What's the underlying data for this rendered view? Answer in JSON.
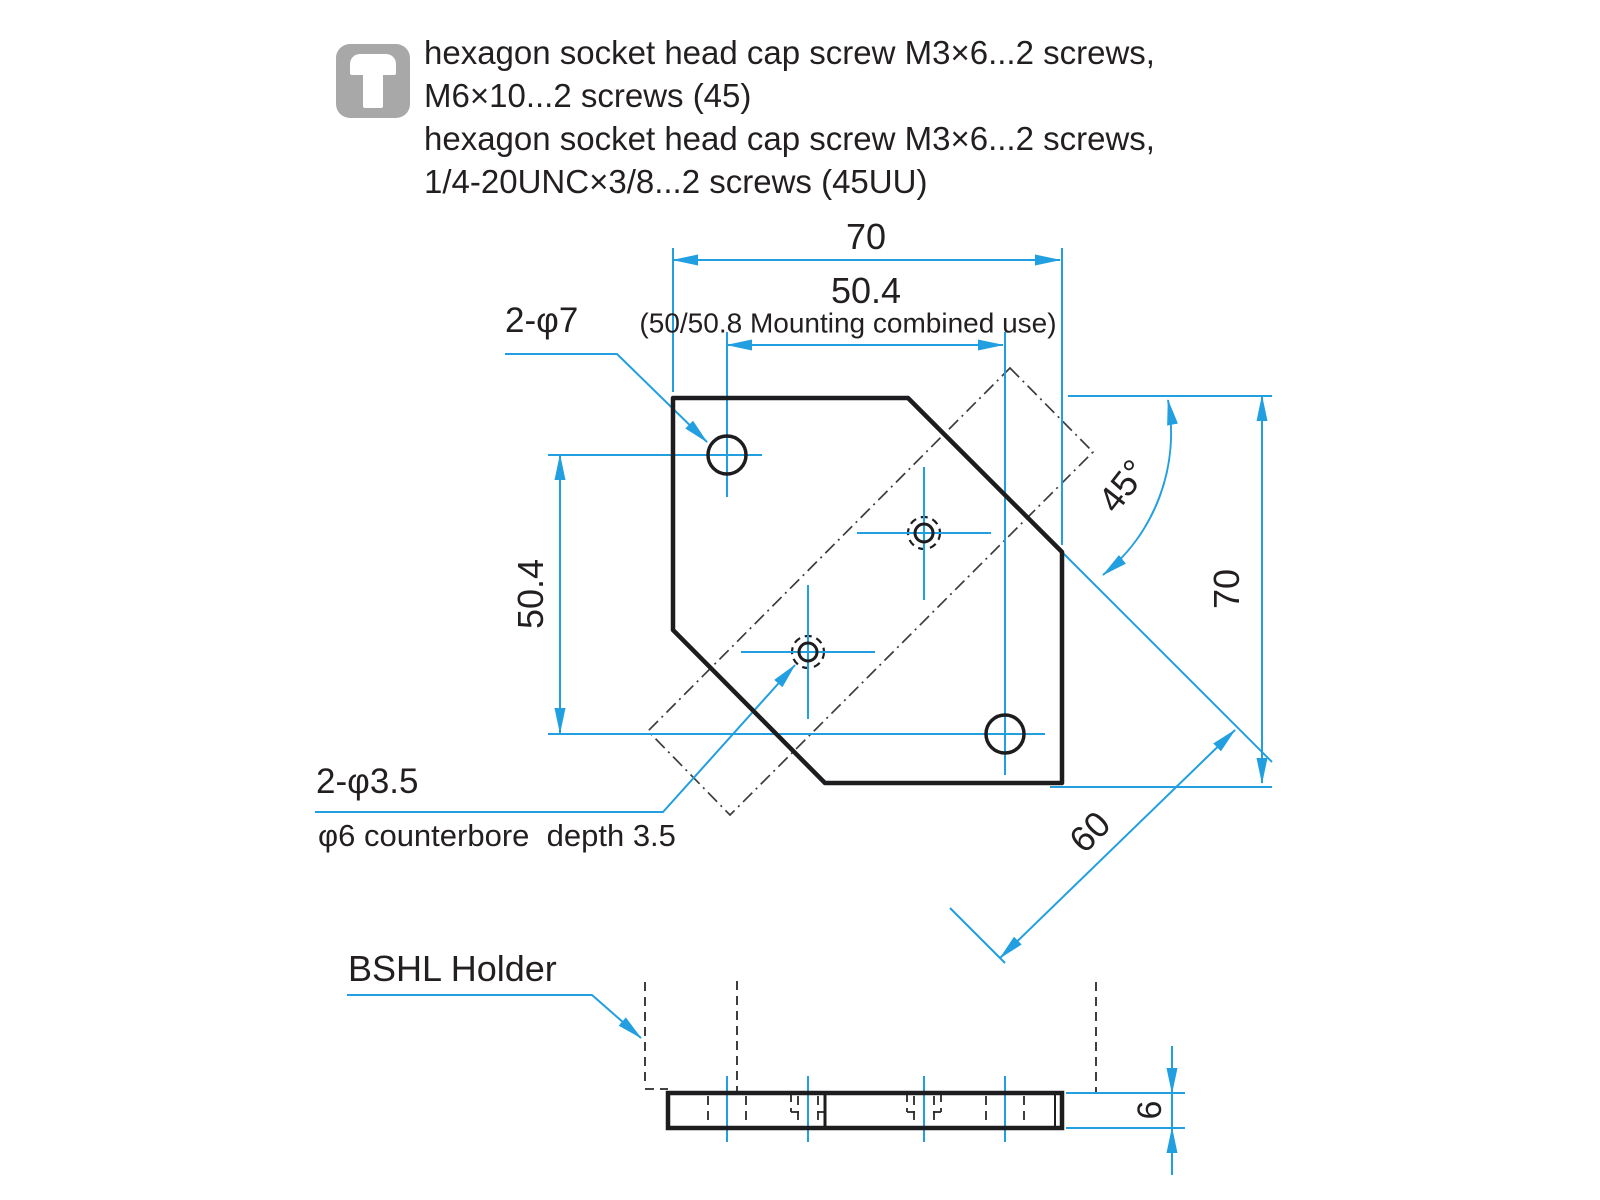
{
  "notes": {
    "icon": "screw-icon",
    "lines": [
      "hexagon socket head cap screw M3×6...2 screws,",
      "M6×10...2 screws (45)",
      "hexagon socket head cap screw M3×6...2 screws,",
      "1/4-20UNC×3/8...2 screws (45UU)"
    ]
  },
  "part_label": "BSHL Holder",
  "top_view": {
    "dims": {
      "width": "70",
      "mounting": "50.4",
      "mounting_note": "(50/50.8 Mounting combined use)",
      "height": "70",
      "left_height": "50.4",
      "angle": "45°",
      "diagonal": "60"
    },
    "labels": {
      "through_holes": "2-φ7",
      "counterbore_holes": "2-φ3.5",
      "counterbore_note": "φ6 counterbore  depth 3.5"
    }
  },
  "side_view": {
    "thickness": "6"
  },
  "colors": {
    "dimension_blue": "#219fe0",
    "outline_black": "#1d1d1f",
    "icon_gray": "#a8a8a8"
  }
}
